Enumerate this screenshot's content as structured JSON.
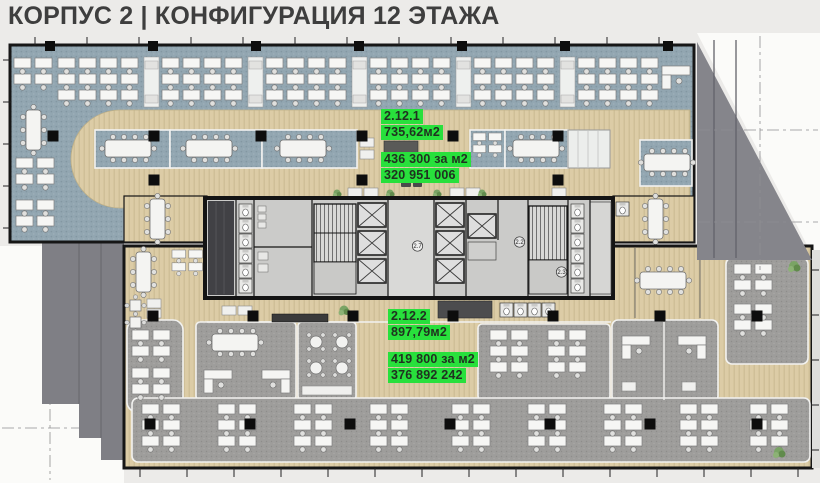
{
  "title": "КОРПУС 2 | КОНФИГУРАЦИЯ 12 ЭТАЖА",
  "units": [
    {
      "id": "2.12.1",
      "area": "735,62м2",
      "price_per_m2": "436 300 за м2",
      "total": "320 951 006"
    },
    {
      "id": "2.12.2",
      "area": "897,79м2",
      "price_per_m2": "419 800 за м2",
      "total": "376 892 242"
    }
  ],
  "core_room_tags": [
    "2.7",
    "2.2",
    "2.3"
  ],
  "colors": {
    "highlight_green": "#28e03c",
    "label_text": "#203220",
    "carpet_blue": "#92a6b1",
    "floor_beige": "#dccca6",
    "carpet_gray": "#9e9d9b",
    "wall_black": "#161616",
    "shadow_gray": "#85858b",
    "background": "#ecebe9",
    "title_text": "#3e3e3e"
  }
}
